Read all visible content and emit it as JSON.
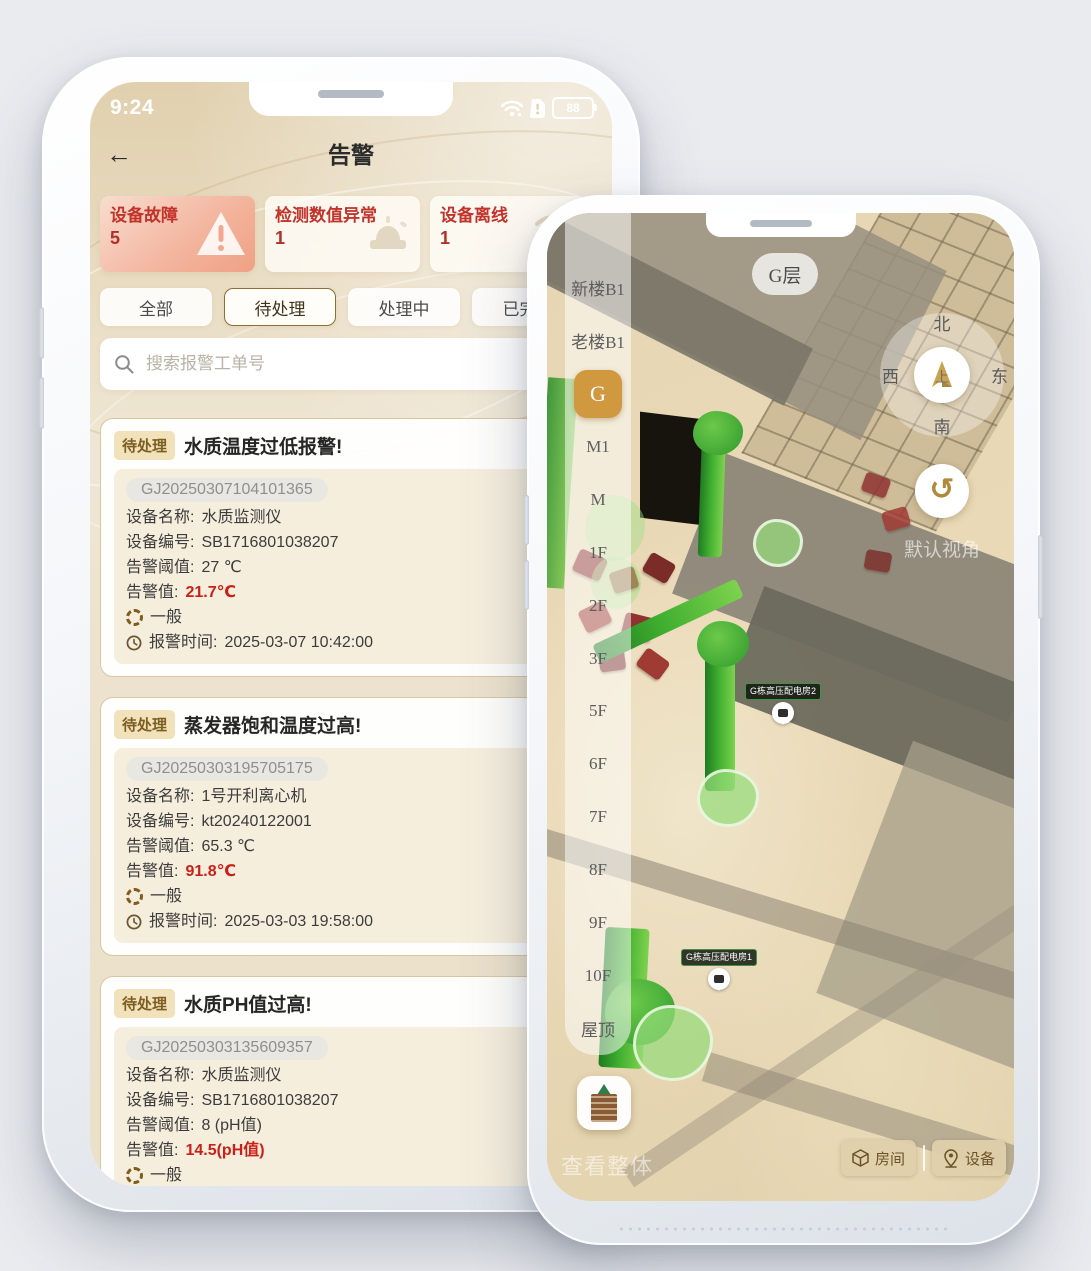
{
  "left_phone": {
    "status_bar": {
      "time": "9:24",
      "battery_level": "88"
    },
    "nav": {
      "back_icon": "←",
      "title": "告警"
    },
    "stat_cards": [
      {
        "label": "设备故障",
        "count": "5",
        "icon": "warning-triangle"
      },
      {
        "label": "检测数值异常",
        "count": "1",
        "icon": "alarm-siren"
      },
      {
        "label": "设备离线",
        "count": "1",
        "icon": "device-offline"
      }
    ],
    "tabs": [
      {
        "label": "全部",
        "selected": false
      },
      {
        "label": "待处理",
        "selected": true
      },
      {
        "label": "处理中",
        "selected": false
      },
      {
        "label": "已完成",
        "selected": false
      }
    ],
    "search_placeholder": "搜索报警工单号",
    "alarms": [
      {
        "status": "待处理",
        "title": "水质温度过低报警!",
        "order_id": "GJ20250307104101365",
        "name_label": "设备名称:",
        "name": "水质监测仪",
        "code_label": "设备编号:",
        "code": "SB1716801038207",
        "threshold_label": "告警阈值:",
        "threshold": "27 ℃",
        "value_label": "告警值:",
        "value": "21.7℃",
        "level": "一般",
        "time_label": "报警时间:",
        "time": "2025-03-07 10:42:00"
      },
      {
        "status": "待处理",
        "title": "蒸发器饱和温度过高!",
        "order_id": "GJ20250303195705175",
        "name_label": "设备名称:",
        "name": "1号开利离心机",
        "code_label": "设备编号:",
        "code": "kt20240122001",
        "threshold_label": "告警阈值:",
        "threshold": "65.3 ℃",
        "value_label": "告警值:",
        "value": "91.8℃",
        "level": "一般",
        "time_label": "报警时间:",
        "time": "2025-03-03 19:58:00"
      },
      {
        "status": "待处理",
        "title": "水质PH值过高!",
        "order_id": "GJ20250303135609357",
        "name_label": "设备名称:",
        "name": "水质监测仪",
        "code_label": "设备编号:",
        "code": "SB1716801038207",
        "threshold_label": "告警阈值:",
        "threshold": "8 (pH值)",
        "value_label": "告警值:",
        "value": "14.5(pH值)",
        "level": "一般",
        "time_label": "报警时间:",
        "time": "2025-03-03 13:57:00"
      }
    ]
  },
  "right_phone": {
    "current_floor_label": "G层",
    "floors": [
      "新楼B1",
      "老楼B1",
      "G",
      "M1",
      "M",
      "1F",
      "2F",
      "3F",
      "5F",
      "6F",
      "7F",
      "8F",
      "9F",
      "10F",
      "屋顶"
    ],
    "selected_floor": "G",
    "compass": {
      "north": "北",
      "south": "南",
      "west": "西",
      "east": "东",
      "center": "上"
    },
    "reset_icon": "↺",
    "reset_view_label": "默认视角",
    "scene_markers": [
      {
        "label": "G栋高压配电房2"
      },
      {
        "label": "G栋高压配电房1"
      }
    ],
    "overview_label": "查看整体",
    "mode_buttons": [
      {
        "label": "房间",
        "icon": "cube"
      },
      {
        "label": "设备",
        "icon": "device-pin"
      }
    ]
  },
  "colors": {
    "accent_gold": "#d0983f",
    "alert_red": "#c2332b",
    "value_red": "#c9201a",
    "badge_tan": "#f1e2bc",
    "panel_beige": "#f6eedd"
  }
}
